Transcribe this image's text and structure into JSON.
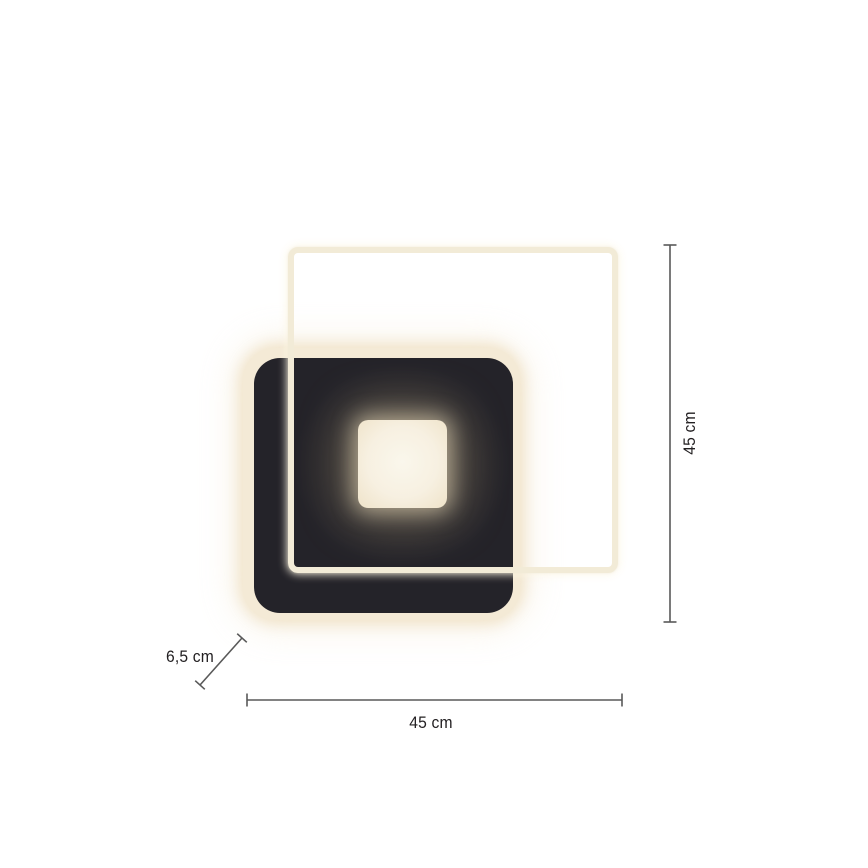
{
  "product_diagram": {
    "dimensions": {
      "height_label": "45 cm",
      "width_label": "45 cm",
      "depth_label": "6,5 cm"
    },
    "colors": {
      "background": "#ffffff",
      "panel_black": "#242329",
      "led_frame_cream": "#f2ebd7",
      "backplate_glow": "#f4ead6",
      "center_light": "#f8f3e6",
      "dimension_line": "#595959",
      "label_text": "#232022"
    }
  }
}
